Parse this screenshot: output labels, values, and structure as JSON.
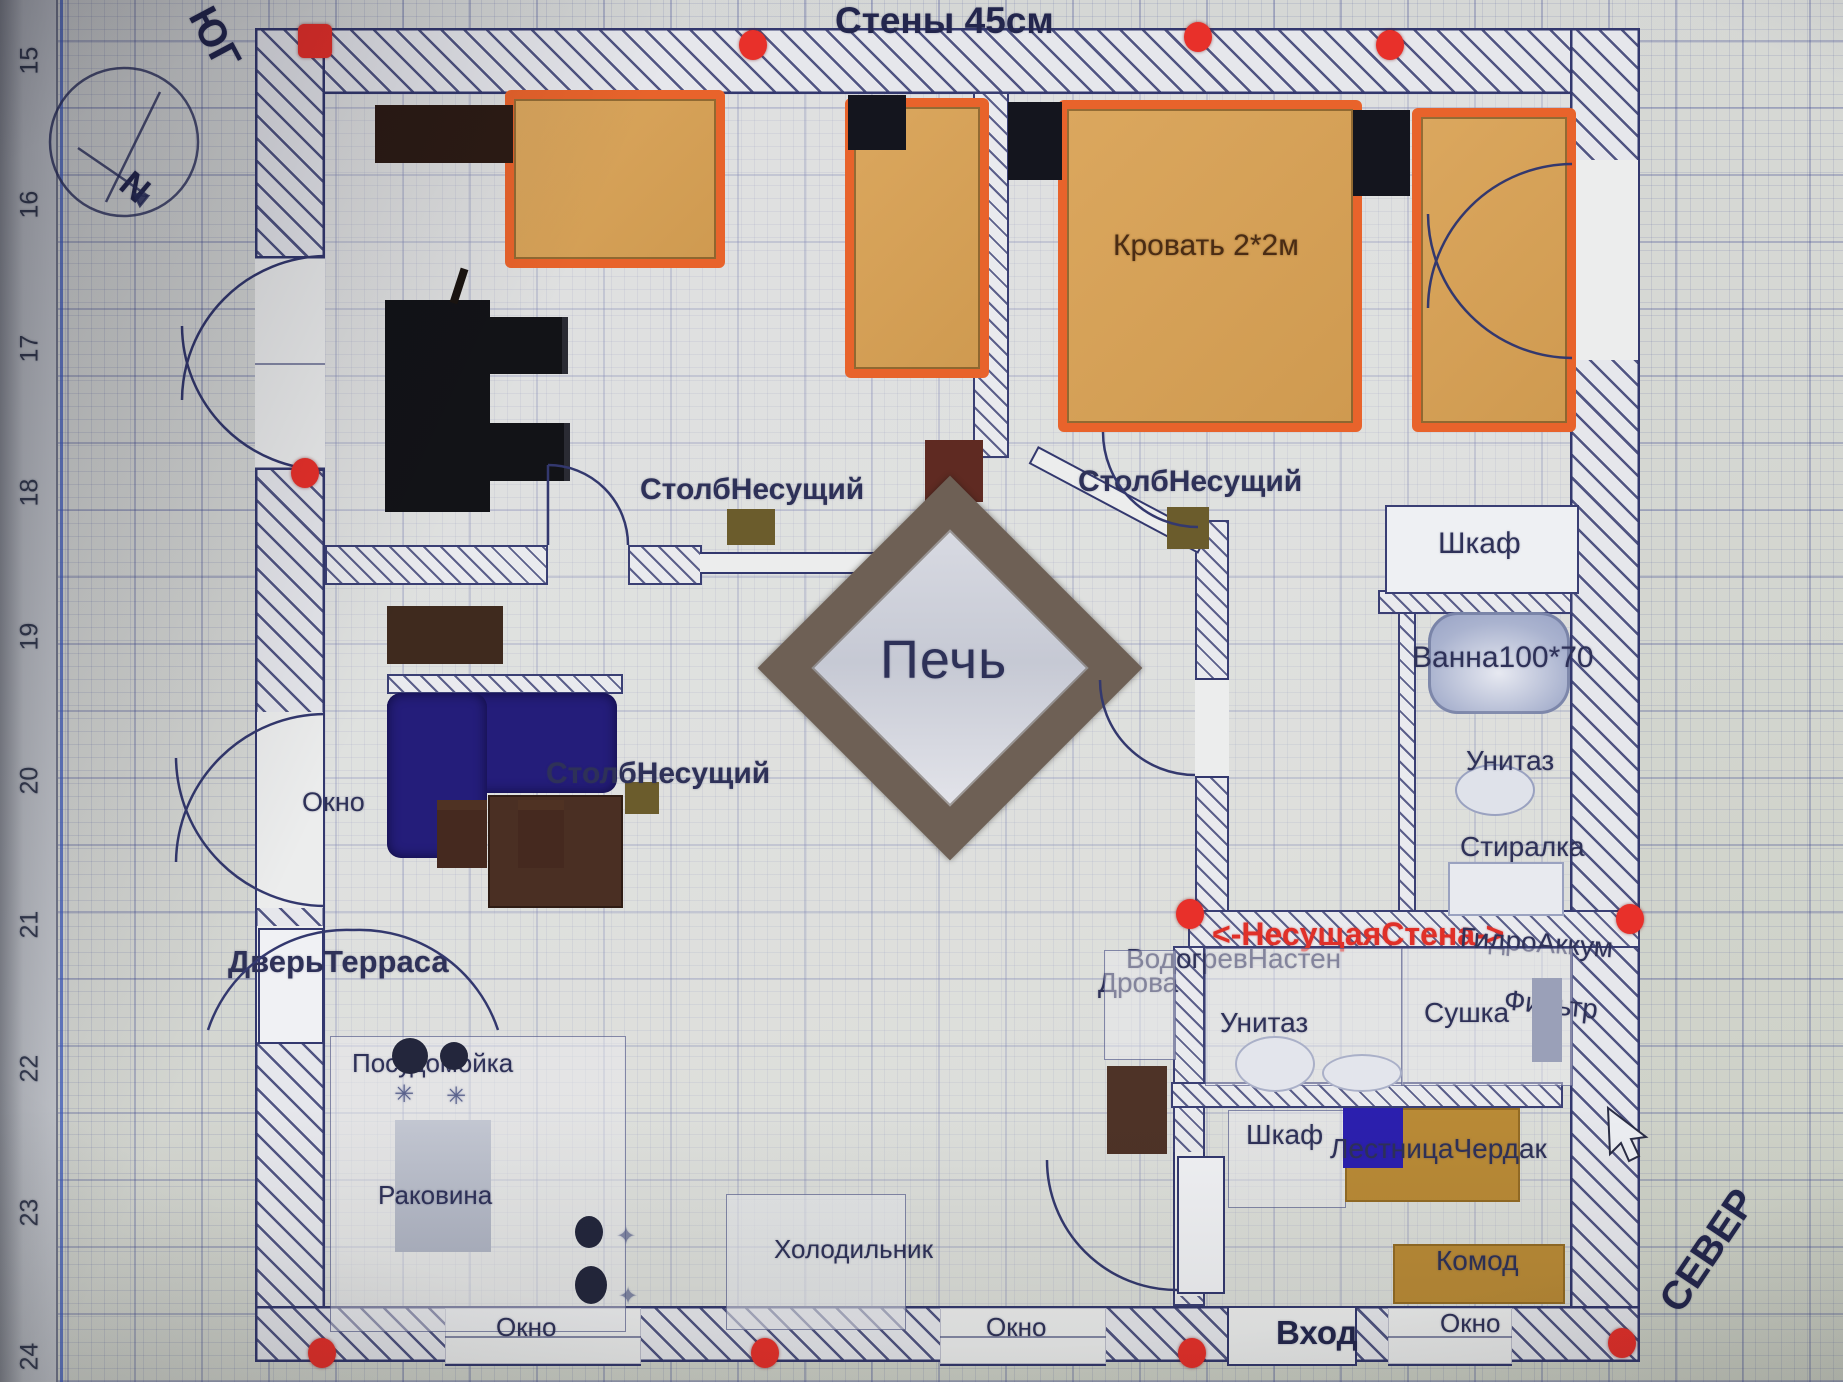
{
  "title": "Стены 45см",
  "compass": {
    "n": "N",
    "south": "ЮГ",
    "north": "СЕВЕР"
  },
  "ruler_ticks": [
    "15",
    "16",
    "17",
    "18",
    "19",
    "20",
    "21",
    "22",
    "23",
    "24"
  ],
  "labels": {
    "bed_big": "Кровать 2*2м",
    "column": "СтолбНесущий",
    "stove": "Печь",
    "wardrobe": "Шкаф",
    "bath": "Ванна100*70",
    "toilet": "Унитаз",
    "washer": "Стиралка",
    "dryer": "Сушка",
    "filter": "Фильтр",
    "hydro": "ГидроАккум",
    "bearing_wall": "<-НесущаяСтена->",
    "water_heater": "ВодогревНастен",
    "firewood": "Дрова",
    "stairs_attic": "ЛестницаЧердак",
    "dresser": "Комод",
    "entrance": "Вход",
    "window": "Окно",
    "terrace_door": "ДверьТерраса",
    "dishwasher": "Посудомойка",
    "sink": "Раковина",
    "fridge": "Холодильник"
  },
  "colors": {
    "bed_fill": "#d8a55e",
    "bed_border": "#e8632b",
    "sofa": "#241d7a",
    "handle_red": "#e8302a",
    "wall_hatch": "#33386e",
    "label_text": "#2e3158",
    "bearing_label_red": "#e03028",
    "stairs_blue": "#2b1fae",
    "wood_tan": "#b98a36",
    "table_brown": "#4a2f23"
  }
}
